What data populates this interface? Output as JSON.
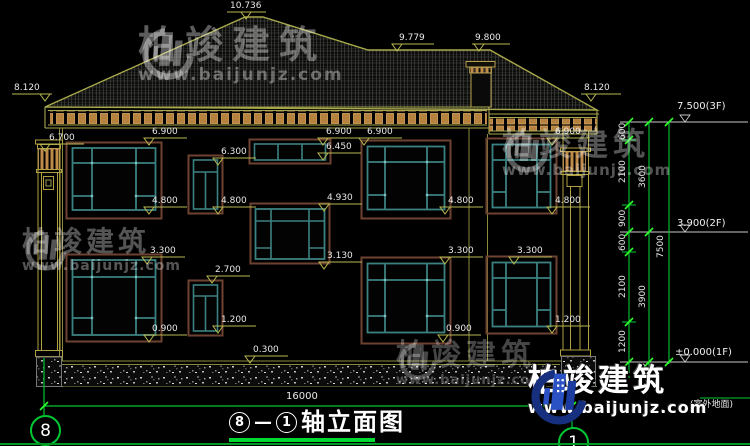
{
  "drawing": {
    "title": {
      "axis_from": "8",
      "separator": "—",
      "axis_to": "1",
      "text": "轴立面图"
    },
    "axis_bubbles": {
      "left": "8",
      "right": "1"
    },
    "overall_width_dim": "16000"
  },
  "watermark": {
    "brand": "柏竣建筑",
    "url": "www.baijunjz.com"
  },
  "levels": {
    "ridge": "10.736",
    "wing_ridge": "9.779",
    "wing_ridge_right": "9.800",
    "eave_left": "8.120",
    "eave_right": "8.120",
    "pilaster_capital": "6.700",
    "win2f_top_left": "6.900",
    "win2f_top_mid": "6.900",
    "win2f_top_center": "6.900",
    "win2f_top_right": "6.900",
    "transom_bottom": "6.450",
    "small2f_top": "6.300",
    "win2f_bottom_left": "4.800",
    "win2f_bottom_small": "4.800",
    "win2f_bottom_center": "4.800",
    "win2f_bottom_right": "4.800",
    "stair_win_top": "4.930",
    "stair_win_bottom": "3.130",
    "win1f_top_left": "3.300",
    "win1f_top_center": "3.300",
    "win1f_top_right": "3.300",
    "small1f_top": "2.700",
    "small1f_bottom": "1.200",
    "win1f_bottom_right": "1.200",
    "win1f_bottom_left": "0.900",
    "win1f_bottom_center": "0.900",
    "porch_step": "0.300"
  },
  "right_chain": {
    "floor3": "7.500(3F)",
    "floor2": "3.900(2F)",
    "floor1": "±0.000(1F)",
    "outdoor_label": "(室外地面)",
    "seg_600a": "600",
    "seg_2100a": "2100",
    "seg_900": "900",
    "seg_600b": "600",
    "seg_2100b": "2100",
    "seg_1200": "1200",
    "seg_450": "450",
    "total_3600": "3600",
    "total_3900": "3900",
    "total_7500": "7500"
  },
  "colors": {
    "accent_green": "#00c832",
    "cad_yellow": "#b8b850",
    "window_teal": "#3c8181",
    "surround_brown": "#6e4231",
    "dentil_tan": "#b5833f",
    "logo_blue": "#2a52c4"
  }
}
